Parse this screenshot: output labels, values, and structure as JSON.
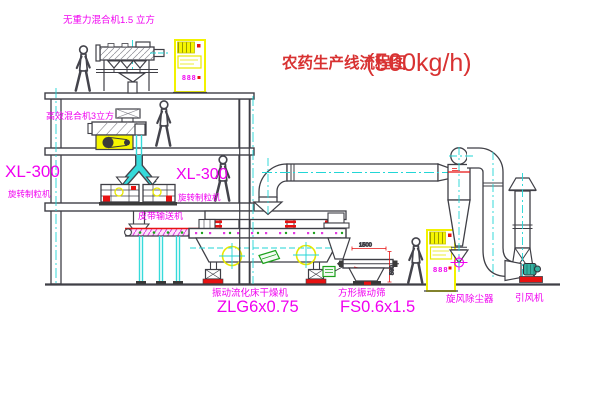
{
  "title": {
    "text": "农药生产线流程图",
    "capacity": "(500kg/h)"
  },
  "labels": {
    "top_mixer": "无重力混合机1.5 立方",
    "mid_mixer": "高效混合机3立方",
    "granulator_model_left": "XL-300",
    "granulator_name_left": "旋转制粒机",
    "granulator_model_mid": "XL-300",
    "granulator_name_mid": "旋转制粒机",
    "belt_conveyor": "皮带输送机",
    "dryer_name": "振动流化床干燥机",
    "dryer_model": "ZLG6x0.75",
    "sieve_name": "方形振动筛",
    "sieve_model": "FS0.6x1.5",
    "cyclone": "旋风除尘器",
    "fan": "引风机"
  },
  "dimensions": {
    "sieve_length": "1500",
    "sieve_height": "590"
  },
  "cabinets": {
    "top_display": "888",
    "right_display": "888"
  },
  "colors": {
    "label_magenta": "#f000f0",
    "title_red": "#d83232",
    "line_dark": "#3f3f46",
    "centerline_cyan": "#22d6d6",
    "cabinet_yellow": "#f2f200",
    "accent_red": "#e81212",
    "accent_green": "#1ba11b",
    "accent_yellow": "#e8e800"
  }
}
